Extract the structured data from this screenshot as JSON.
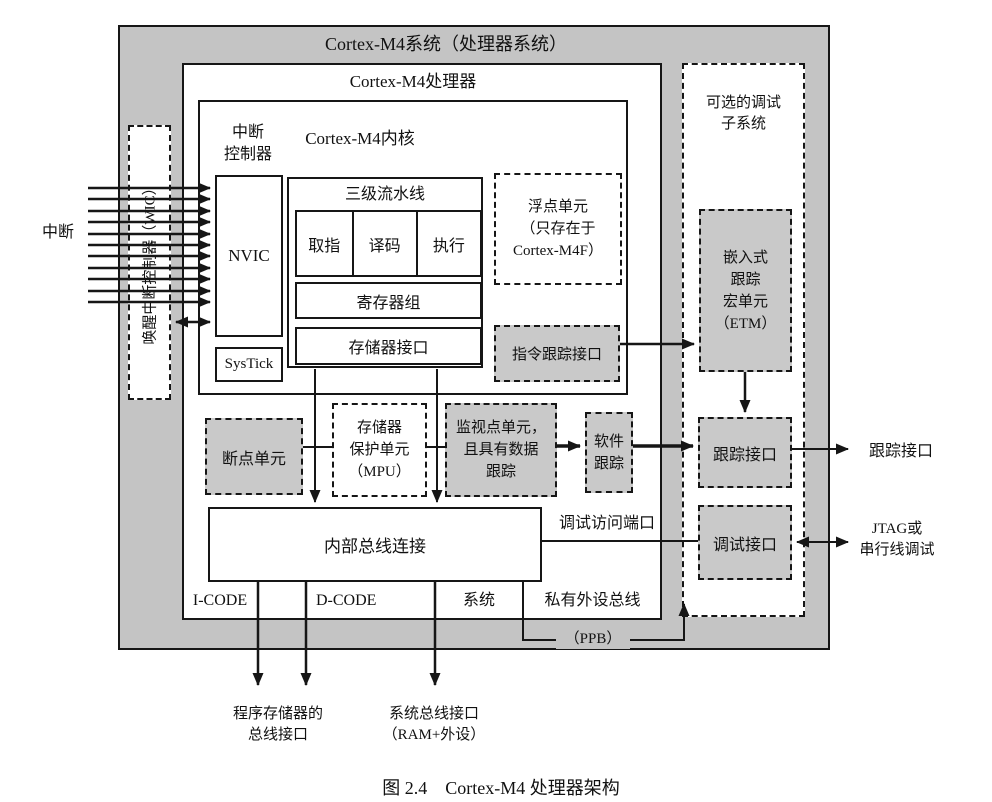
{
  "colors": {
    "frame_gray": "#c4c4c4",
    "unit_gray": "#c9c9c9",
    "line_black": "#161616"
  },
  "titles": {
    "system": "Cortex-M4系统（处理器系统）",
    "processor": "Cortex-M4处理器",
    "core": "Cortex-M4内核",
    "debug_subsystem": [
      "可选的调试",
      "子系统"
    ],
    "caption": "图 2.4　Cortex-M4 处理器架构"
  },
  "blocks": {
    "interrupt_controller": [
      "中断",
      "控制器"
    ],
    "nvic": "NVIC",
    "systick": "SysTick",
    "pipeline": "三级流水线",
    "stages": [
      "取指",
      "译码",
      "执行"
    ],
    "registers": "寄存器组",
    "mem_interface": "存储器接口",
    "fpu": [
      "浮点单元",
      "（只存在于",
      "Cortex-M4F）"
    ],
    "instr_trace": "指令跟踪接口",
    "breakpoint": "断点单元",
    "mpu": [
      "存储器",
      "保护单元",
      "（MPU）"
    ],
    "watchpoint": [
      "监视点单元，",
      "且具有数据",
      "跟踪"
    ],
    "sw_trace": [
      "软件",
      "跟踪"
    ],
    "internal_bus": "内部总线连接",
    "etm": [
      "嵌入式",
      "跟踪",
      "宏单元",
      "（ETM）"
    ],
    "trace_if": "跟踪接口",
    "debug_if": "调试接口",
    "wic": "唤醒中断控制器（WIC）"
  },
  "labels": {
    "interrupts": "中断",
    "dap": "调试访问端口",
    "bus_icode": "I-CODE",
    "bus_dcode": "D-CODE",
    "bus_system": "系统",
    "bus_ppb": "私有外设总线",
    "ppb": "（PPB）",
    "trace_out": "跟踪接口",
    "jtag": [
      "JTAG或",
      "串行线调试"
    ],
    "program_bus": [
      "程序存储器的",
      "总线接口"
    ],
    "system_bus": [
      "系统总线接口",
      "（RAM+外设）"
    ]
  }
}
